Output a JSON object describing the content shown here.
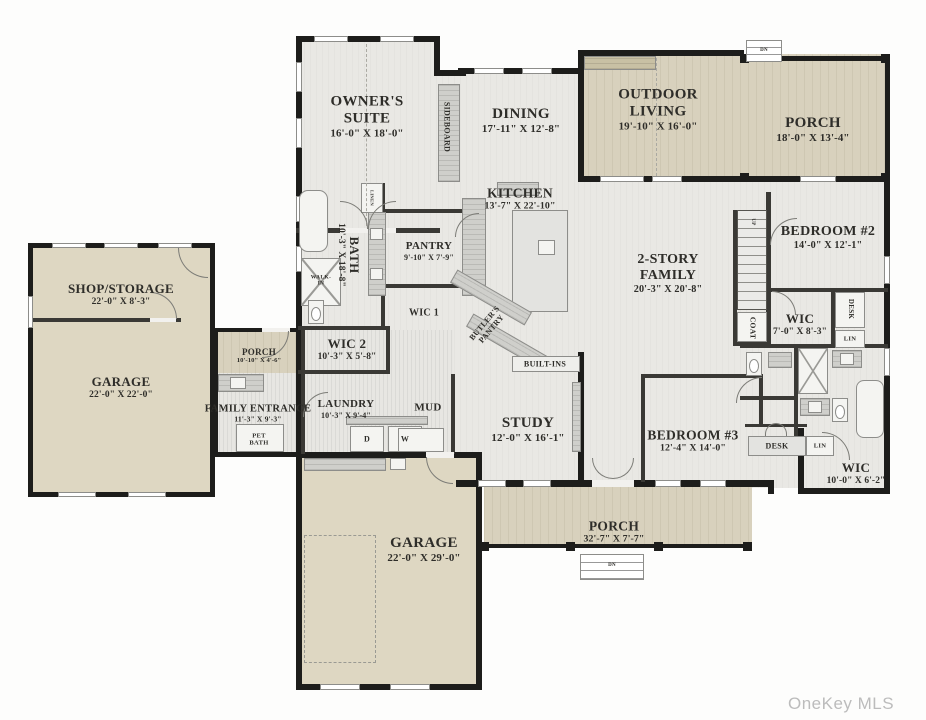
{
  "watermark": "OneKey MLS",
  "colors": {
    "wall": "#1d1d1b",
    "interior": "#e9e8e4",
    "deck": "#d8d1bd",
    "garage": "#ded7c2",
    "text": "#2e2d29"
  },
  "rooms": {
    "owners_suite": {
      "name": "OWNER'S SUITE",
      "dims": "16'-0\" X 18'-0\""
    },
    "dining": {
      "name": "DINING",
      "dims": "17'-11\" X 12'-8\""
    },
    "kitchen": {
      "name": "KITCHEN",
      "dims": "13'-7\" X 22'-10\""
    },
    "outdoor_living": {
      "name": "OUTDOOR LIVING",
      "dims": "19'-10\" X 16'-0\""
    },
    "porch_top": {
      "name": "PORCH",
      "dims": "18'-0\" X 13'-4\""
    },
    "family": {
      "name": "2-STORY FAMILY",
      "dims": "20'-3\" X 20'-8\""
    },
    "bedroom2": {
      "name": "BEDROOM #2",
      "dims": "14'-0\" X 12'-1\""
    },
    "wic_bed2": {
      "name": "WIC",
      "dims": "7'-0\" X 8'-3\""
    },
    "bath_owner": {
      "name": "BATH",
      "dims": "10'-3\" X 18'-8\""
    },
    "pantry": {
      "name": "PANTRY",
      "dims": "9'-10\" X 7'-9\""
    },
    "wic1": {
      "name": "WIC 1"
    },
    "wic2": {
      "name": "WIC 2",
      "dims": "10'-3\" X 5'-8\""
    },
    "laundry": {
      "name": "LAUNDRY",
      "dims": "10'-3\" X 9'-4\""
    },
    "family_entrance": {
      "name": "FAMILY ENTRANCE",
      "dims": "11'-3\" X 9'-3\""
    },
    "porch_left": {
      "name": "PORCH",
      "dims": "10'-10\" X 4'-6\""
    },
    "shop": {
      "name": "SHOP/STORAGE",
      "dims": "22'-0\" X 8'-3\""
    },
    "garage_left": {
      "name": "GARAGE",
      "dims": "22'-0\" X 22'-0\""
    },
    "garage_bottom": {
      "name": "GARAGE",
      "dims": "22'-0\" X 29'-0\""
    },
    "study": {
      "name": "STUDY",
      "dims": "12'-0\" X 16'-1\""
    },
    "bedroom3": {
      "name": "BEDROOM #3",
      "dims": "12'-4\" X 14'-0\""
    },
    "wic_br": {
      "name": "WIC",
      "dims": "10'-0\" X 6'-2\""
    },
    "porch_bottom": {
      "name": "PORCH",
      "dims": "32'-7\" X 7'-7\""
    }
  },
  "labels": {
    "sideboard": "SIDEBOARD",
    "linen": "LINEN",
    "walk_in": "WALK-IN",
    "butlers_pantry": "BUTLER'S PANTRY",
    "built_ins": "BUILT-INS",
    "mud": "MUD",
    "coat": "COAT",
    "up": "UP",
    "dn": "DN",
    "desk": "DESK",
    "lin": "LIN",
    "pet_bath": "PET BATH",
    "dryer": "D",
    "washer": "W"
  }
}
